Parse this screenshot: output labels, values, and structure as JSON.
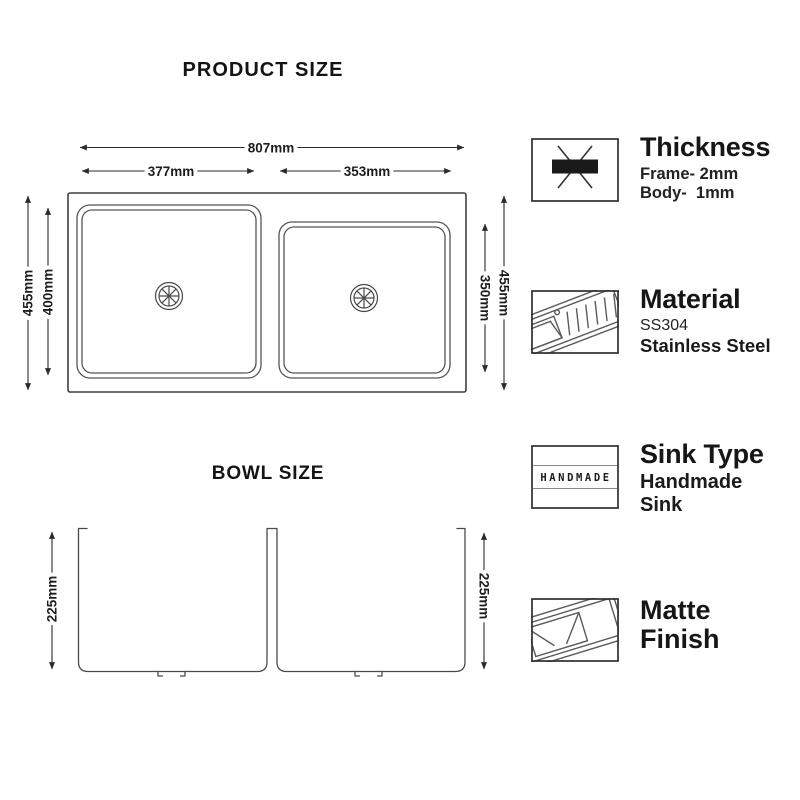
{
  "titles": {
    "product_size": "PRODUCT SIZE",
    "bowl_size": "BOWL SIZE"
  },
  "dimensions": {
    "overall_width": "807mm",
    "left_bowl_width": "377mm",
    "right_bowl_width": "353mm",
    "overall_depth_left": "455mm",
    "left_bowl_inner_depth": "400mm",
    "right_bowl_inner_depth": "350mm",
    "overall_depth_right": "455mm",
    "left_bowl_height": "225mm",
    "right_bowl_height": "225mm"
  },
  "features": [
    {
      "title": "Thickness",
      "sub1": "Frame- 2mm",
      "sub2": "Body-  1mm",
      "icon": "metal-thickness-icon"
    },
    {
      "title": "Material",
      "sub1": "SS304",
      "sub2": "Stainless Steel",
      "icon": "stainless-sink-icon"
    },
    {
      "title": "Sink Type",
      "sub1": "Handmade",
      "sub2": "Sink",
      "icon": "handmade-label-icon",
      "icon_label": "HANDMADE"
    },
    {
      "title_line1": "Matte",
      "title_line2": "Finish",
      "icon": "matte-finish-sink-icon"
    }
  ],
  "colors": {
    "background": "#ffffff",
    "line": "#3c3c3c",
    "text": "#1a1a1a"
  }
}
